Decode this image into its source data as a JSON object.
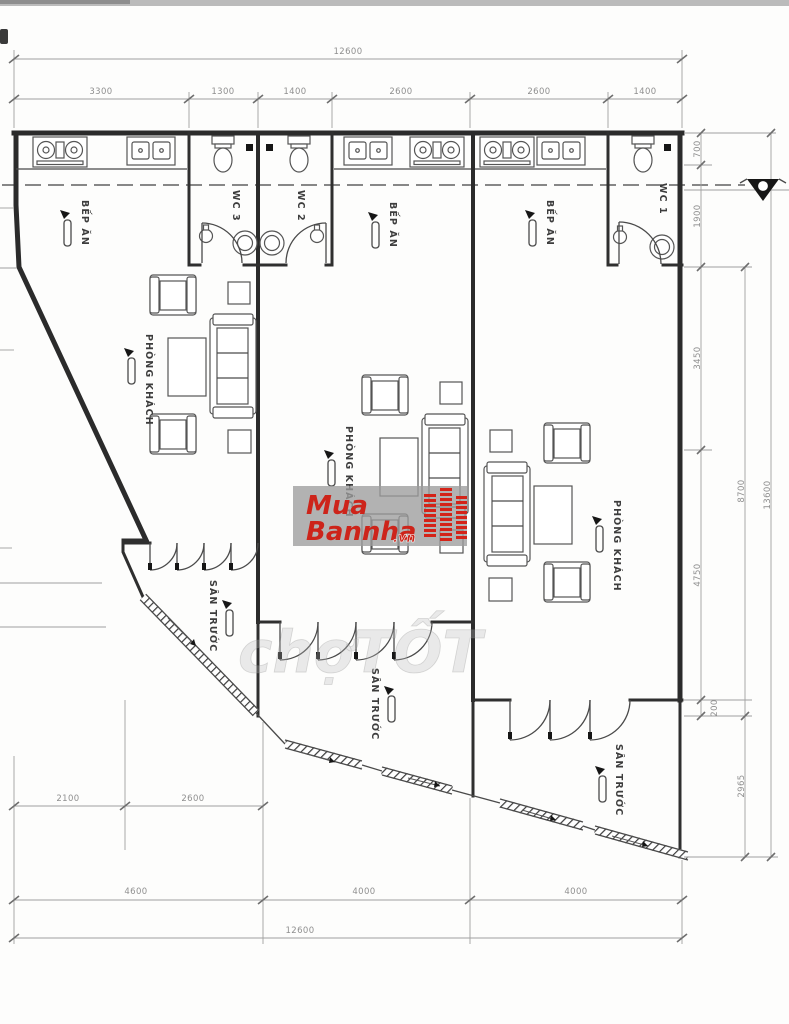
{
  "labels": {
    "kitchen": "BẾP ĂN",
    "living": "PHÒNG KHÁCH",
    "yard": "SÂN TRƯỚC",
    "wc1": "WC 1",
    "wc2": "WC 2",
    "wc3": "WC 3"
  },
  "dimensions": {
    "top_overall": "12600",
    "top_chain": [
      "3300",
      "1300",
      "1400",
      "2600",
      "2600",
      "1400"
    ],
    "bottom_chain": [
      "4600",
      "4000",
      "4000"
    ],
    "bottom_overall": "12600",
    "bottom_left_chain": [
      "2100",
      "2600"
    ],
    "right_chain": [
      "700",
      "1900",
      "3450",
      "4750",
      "200",
      "2965"
    ],
    "right_overall": [
      "8700",
      "13600"
    ]
  },
  "watermark": {
    "line1": "Mua",
    "line2": "Bannha",
    "tld": ".vn",
    "accent_color": "#cd241a",
    "band_color": "#9c9c9c"
  },
  "watermark2": {
    "text": "chợTỐT"
  }
}
